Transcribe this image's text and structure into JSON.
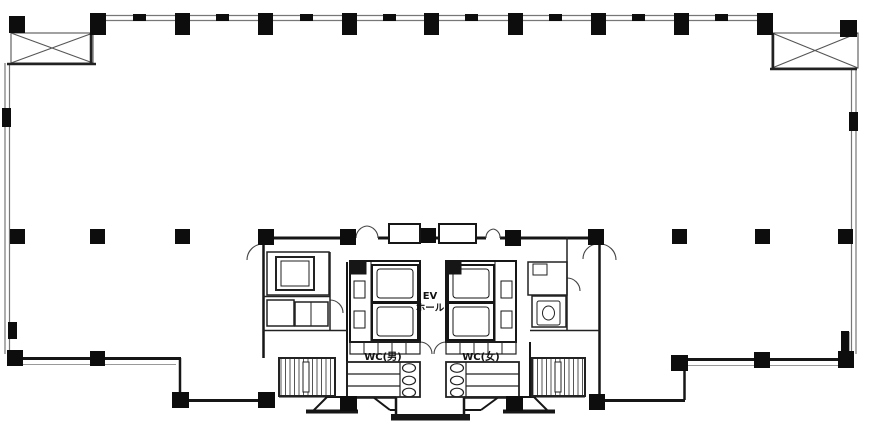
{
  "plan": {
    "labels": {
      "elevator_hall": {
        "line1": "EV",
        "line2": "ホール"
      },
      "wc_men": "WC(男)",
      "wc_women": "WC(女)"
    },
    "colors": {
      "wall": "#161616",
      "light_wall": "#777777",
      "hatch": "#555555",
      "paper": "#ffffff"
    }
  }
}
